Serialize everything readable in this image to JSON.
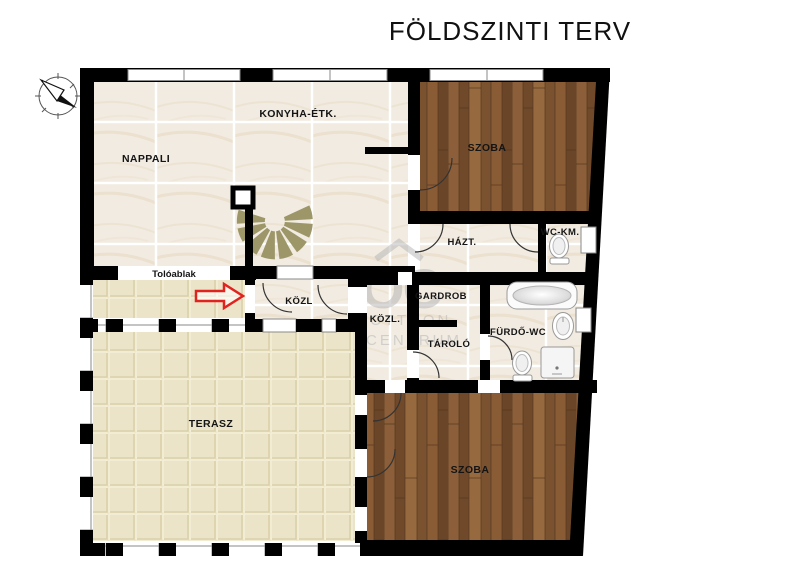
{
  "title": "FÖLDSZINTI TERV",
  "compass": {
    "label": "N"
  },
  "watermark": {
    "logo": "OC",
    "line1": "OTTHON",
    "line2": "CENTRUM"
  },
  "rooms": {
    "nappali": "NAPPALI",
    "konyha": "KONYHA-ÉTK.",
    "szoba_top": "SZOBA",
    "hazt": "HÁZT.",
    "wckm": "WC-KM.",
    "toloablak": "Tolóablak",
    "kozl_entry": "KÖZL",
    "gardrob": "GARDROB",
    "kozl2": "KÖZL.",
    "tarolo": "TÁROLÓ",
    "furdo": "FÜRDŐ-WC",
    "terasz": "TERASZ",
    "szoba_bottom": "SZOBA"
  },
  "colors": {
    "wall": "#000000",
    "wood_floor": "#845a36",
    "marble_floor": "#f1ebe1",
    "terrace_tile": "#ebe2c2",
    "stairs": "#9c9668",
    "arrow": "#e0231e",
    "watermark": "#b3b3b3"
  }
}
